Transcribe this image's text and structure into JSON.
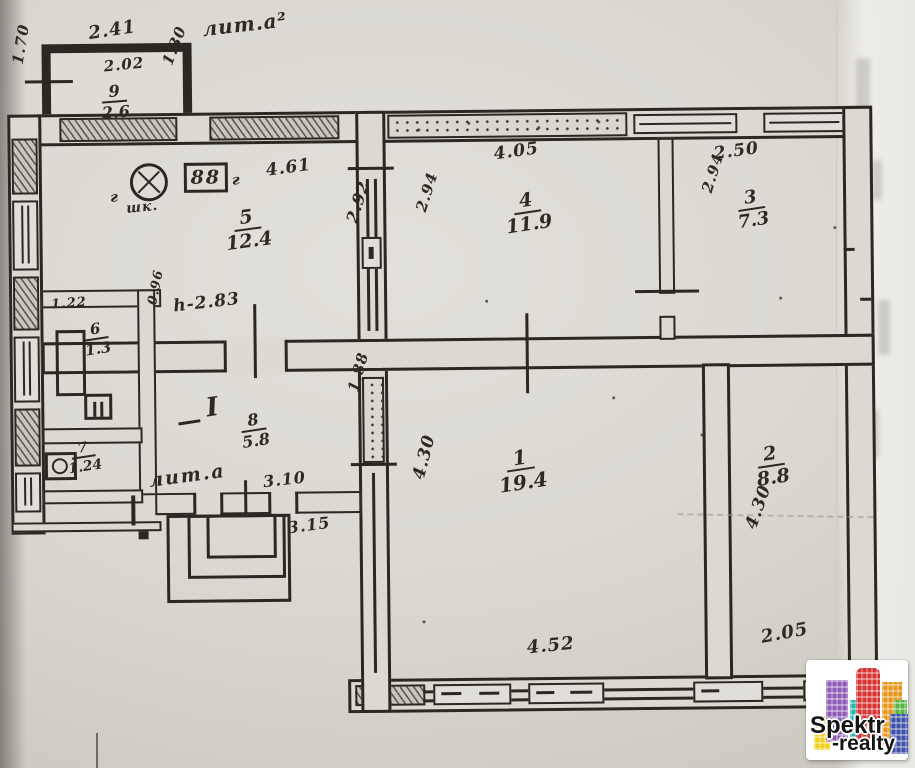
{
  "plan": {
    "labels": {
      "annex_upper": "лит.а²",
      "annex_lower": "лит.а",
      "height_note": "h-2.83",
      "hall_roman": "I",
      "gas_left": "г",
      "cupboard": "шк.",
      "gas_right": "г"
    },
    "symbols": {
      "stove_burners": "88"
    },
    "rooms": [
      {
        "number": "9",
        "area": "2.6"
      },
      {
        "number": "5",
        "area": "12.4"
      },
      {
        "number": "4",
        "area": "11.9"
      },
      {
        "number": "3",
        "area": "7.3"
      },
      {
        "number": "6",
        "area": "1.3"
      },
      {
        "number": "7",
        "area": "1.24"
      },
      {
        "number": "8",
        "area": "5.8"
      },
      {
        "number": "1",
        "area": "19.4"
      },
      {
        "number": "2",
        "area": "8.8"
      }
    ],
    "dimensions": {
      "annex_top_outer": "2.41",
      "annex_top_inner": "2.02",
      "annex_right": "1.30",
      "annex_left": "1.70",
      "room5_top": "4.61",
      "room5_right": "2.92",
      "room4_left": "2.94",
      "room4_top": "4.05",
      "room3_left": "2.94",
      "room3_top": "2.50",
      "room6_top": "1.22",
      "room6_right": "0.96",
      "hall_bottom": "3.10",
      "porch_bottom": "3.15",
      "room1_left_upper": "1.88",
      "room1_left": "4.30",
      "room1_bottom": "4.52",
      "room2_left": "4.30",
      "room2_bottom": "2.05"
    }
  },
  "watermark": {
    "line1": "Spektr",
    "line2": "-realty"
  },
  "colors": {
    "ink": "#2b2722",
    "paper": "#dbd9d2",
    "logo_red": "#d63333",
    "logo_purple": "#8e5bb5",
    "logo_teal": "#2ab5b0",
    "logo_orange": "#e8951d",
    "logo_yellow": "#f0cf1d",
    "logo_green": "#57b544",
    "logo_blue": "#3f51a8"
  }
}
